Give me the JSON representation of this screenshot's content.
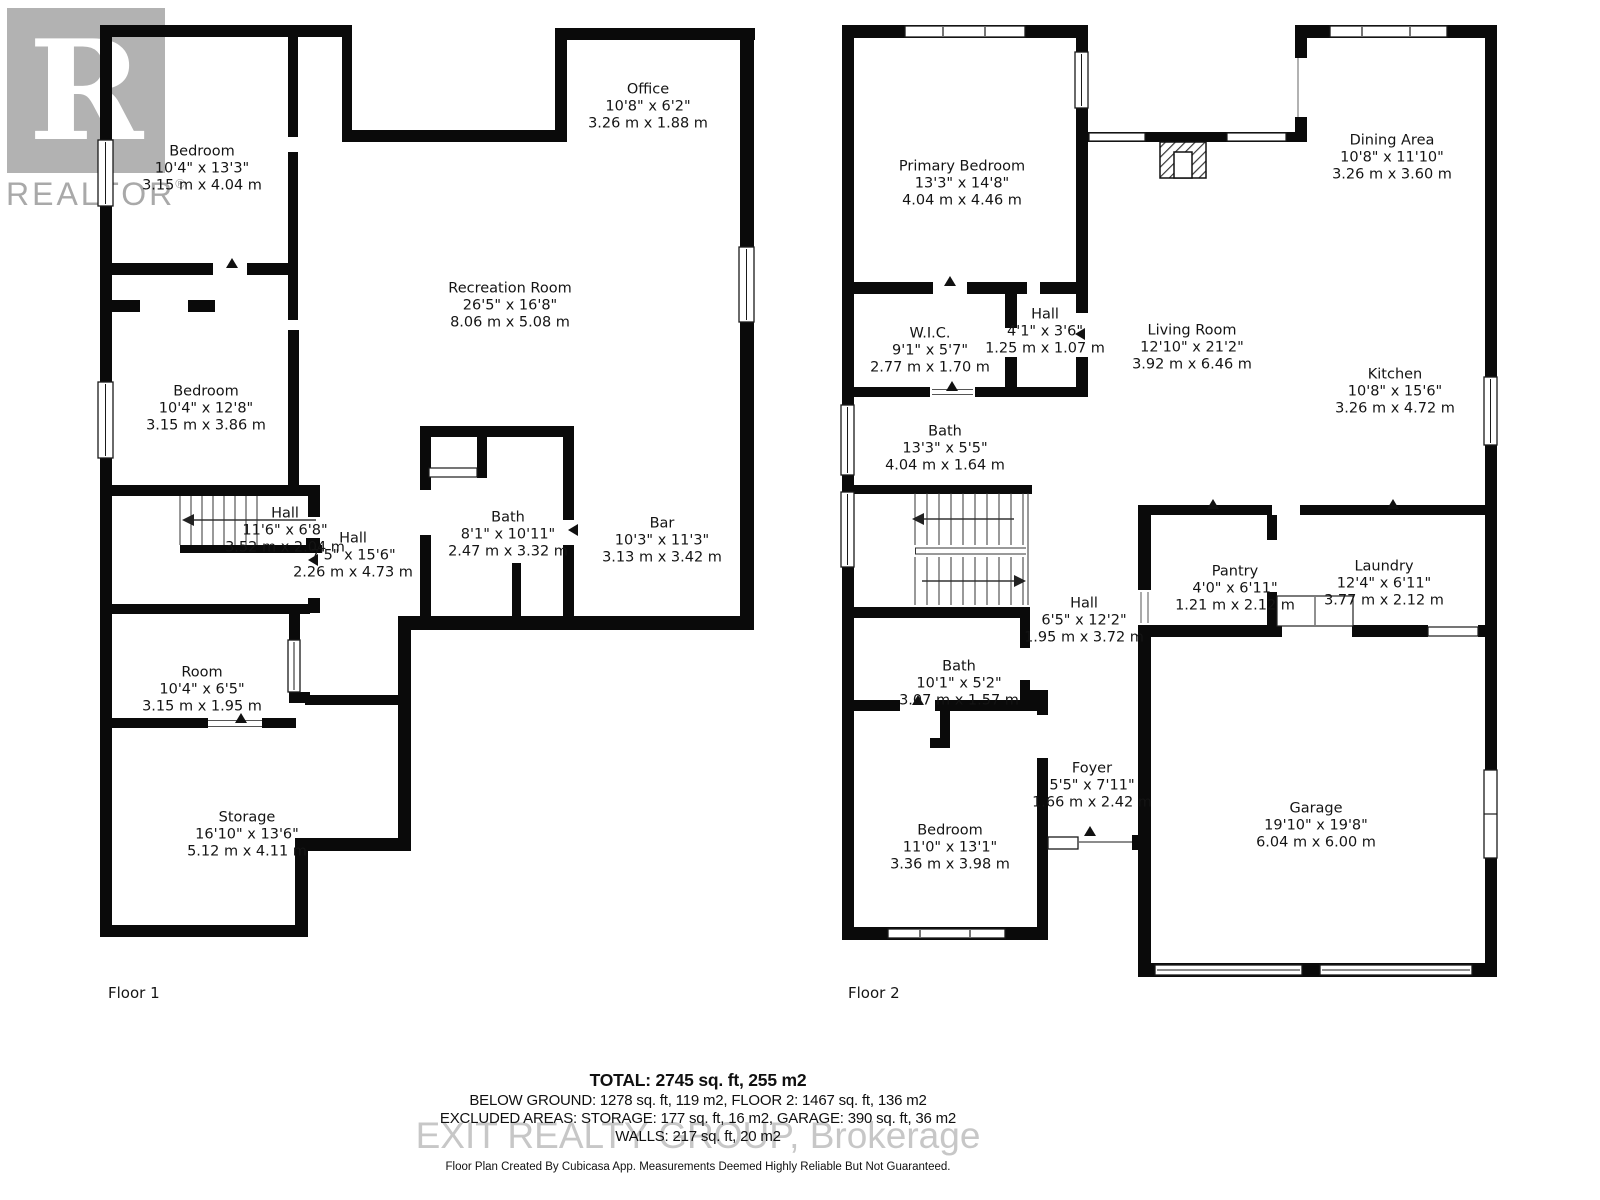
{
  "watermarks": {
    "realtor_logo_letter": "R",
    "realtor_text": "REALTOR",
    "registered_mark": "®",
    "brokerage_text": "EXIT REALTY GROUP, Brokerage"
  },
  "floor1": {
    "label": "Floor 1",
    "rooms": [
      {
        "name": "Bedroom",
        "imperial": "10'4\" x 13'3\"",
        "metric": "3.15 m x 4.04 m"
      },
      {
        "name": "Office",
        "imperial": "10'8\" x 6'2\"",
        "metric": "3.26 m x 1.88 m"
      },
      {
        "name": "Recreation Room",
        "imperial": "26'5\" x 16'8\"",
        "metric": "8.06 m x 5.08 m"
      },
      {
        "name": "Bedroom",
        "imperial": "10'4\" x 12'8\"",
        "metric": "3.15 m x 3.86 m"
      },
      {
        "name": "Hall",
        "imperial": "11'6\" x 6'8\"",
        "metric": "3.52 m x 2.04 m"
      },
      {
        "name": "Hall",
        "imperial": "7'5\" x 15'6\"",
        "metric": "2.26 m x 4.73 m"
      },
      {
        "name": "Bath",
        "imperial": "8'1\" x 10'11\"",
        "metric": "2.47 m x 3.32 m"
      },
      {
        "name": "Bar",
        "imperial": "10'3\" x 11'3\"",
        "metric": "3.13 m x 3.42 m"
      },
      {
        "name": "Room",
        "imperial": "10'4\" x 6'5\"",
        "metric": "3.15 m x 1.95 m"
      },
      {
        "name": "Storage",
        "imperial": "16'10\" x 13'6\"",
        "metric": "5.12 m x 4.11 m"
      }
    ]
  },
  "floor2": {
    "label": "Floor 2",
    "rooms": [
      {
        "name": "Primary Bedroom",
        "imperial": "13'3\" x 14'8\"",
        "metric": "4.04 m x 4.46 m"
      },
      {
        "name": "Dining Area",
        "imperial": "10'8\" x 11'10\"",
        "metric": "3.26 m x 3.60 m"
      },
      {
        "name": "W.I.C.",
        "imperial": "9'1\" x 5'7\"",
        "metric": "2.77 m x 1.70 m"
      },
      {
        "name": "Hall",
        "imperial": "4'1\" x 3'6\"",
        "metric": "1.25 m x 1.07 m"
      },
      {
        "name": "Living Room",
        "imperial": "12'10\" x 21'2\"",
        "metric": "3.92 m x 6.46 m"
      },
      {
        "name": "Kitchen",
        "imperial": "10'8\" x 15'6\"",
        "metric": "3.26 m x 4.72 m"
      },
      {
        "name": "Bath",
        "imperial": "13'3\" x 5'5\"",
        "metric": "4.04 m x 1.64 m"
      },
      {
        "name": "Hall",
        "imperial": "6'5\" x 12'2\"",
        "metric": "1.95 m x 3.72 m"
      },
      {
        "name": "Pantry",
        "imperial": "4'0\" x 6'11\"",
        "metric": "1.21 m x 2.12 m"
      },
      {
        "name": "Laundry",
        "imperial": "12'4\" x 6'11\"",
        "metric": "3.77 m x 2.12 m"
      },
      {
        "name": "Bath",
        "imperial": "10'1\" x 5'2\"",
        "metric": "3.07 m x 1.57 m"
      },
      {
        "name": "Foyer",
        "imperial": "5'5\" x 7'11\"",
        "metric": "1.66 m x 2.42 m"
      },
      {
        "name": "Bedroom",
        "imperial": "11'0\" x 13'1\"",
        "metric": "3.36 m x 3.98 m"
      },
      {
        "name": "Garage",
        "imperial": "19'10\" x 19'8\"",
        "metric": "6.04 m x 6.00 m"
      }
    ]
  },
  "summary": {
    "total": "TOTAL: 2745 sq. ft, 255 m2",
    "line2": "BELOW GROUND: 1278 sq. ft, 119 m2, FLOOR 2: 1467 sq. ft, 136 m2",
    "line3": "EXCLUDED AREAS: STORAGE: 177 sq. ft, 16 m2, GARAGE: 390 sq. ft, 36 m2",
    "line4": "WALLS: 217 sq. ft, 20 m2",
    "disclaimer": "Floor Plan Created By Cubicasa App. Measurements Deemed Highly Reliable But Not Guaranteed."
  }
}
